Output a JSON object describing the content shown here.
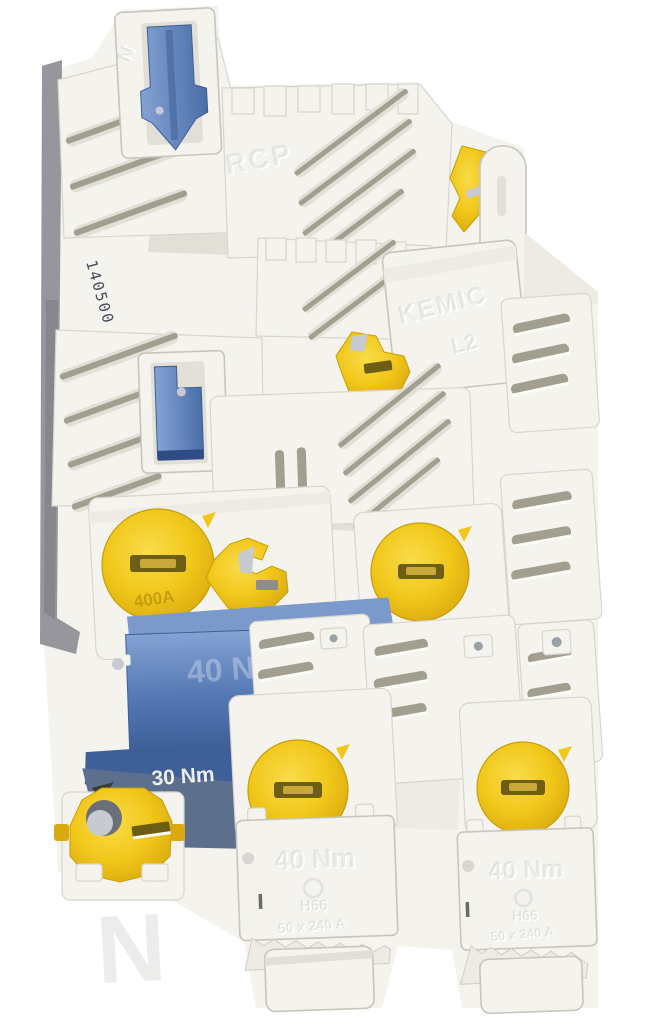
{
  "palette": {
    "background": "#ffffff",
    "plastic": "#f4f3ee",
    "plastic_shadow": "#e1dfd6",
    "side_shadow": "#97969c",
    "slot": "#a29f90",
    "yellow": "#f1c71a",
    "yellow_deep": "#d9a90e",
    "yellow_light": "#f9dc4a",
    "blue": "#5478b4",
    "blue_light": "#84a2d4",
    "blue_deep": "#3e5f98",
    "blue_gray": "#5c6f8d",
    "metal": "#c7cad0",
    "stamp_ink": "#474c5c"
  },
  "markings": {
    "stamp_serial": "140500",
    "embossed_rcp": "RCP",
    "embossed_kemic": "KEMIC",
    "embossed_l2": "L2",
    "embossed_l3": "L3",
    "embossed_n_top": "N",
    "embossed_n_bottom": "N",
    "blue_cover_torque": "40 Nm",
    "blue_cover_code": "46 240",
    "latch_torque": "30 Nm",
    "cap_rating": "400A",
    "cover_center_torque": "40 Nm",
    "cover_center_model": "H66",
    "cover_center_range": "50 x 240 A",
    "cover_right_torque": "40 Nm",
    "cover_right_model": "H66",
    "cover_right_range": "50 x 240 A"
  }
}
